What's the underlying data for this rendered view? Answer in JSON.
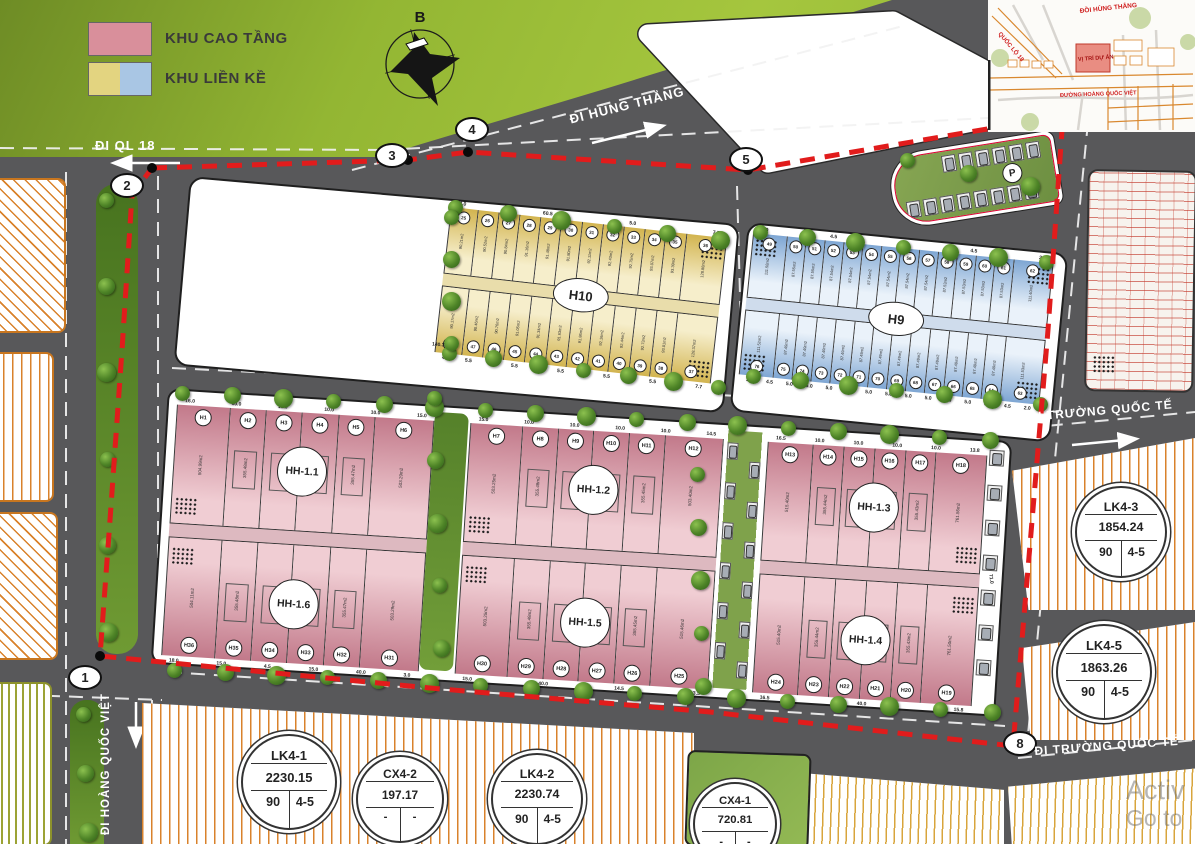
{
  "legend": {
    "items": [
      {
        "label": "KHU CAO TẦNG",
        "colors": [
          "#d98f9b"
        ]
      },
      {
        "label": "KHU LIỀN KỀ",
        "colors": [
          "#e3d480",
          "#a9c6e4"
        ]
      }
    ]
  },
  "compass": {
    "label": "B"
  },
  "road_labels": {
    "ql18": "ĐI QL 18",
    "hung_thang": "ĐI HÙNG THẮNG",
    "truong_quoc_te_upper": "ĐI TRƯỜNG QUỐC TẾ",
    "truong_quoc_te_lower": "ĐI TRƯỜNG QUỐC TẾ",
    "hoang_quoc_viet": "ĐI HOÀNG QUỐC VIỆT"
  },
  "boundary_nodes": [
    {
      "label": "1"
    },
    {
      "label": "2"
    },
    {
      "label": "3"
    },
    {
      "label": "4"
    },
    {
      "label": "5"
    },
    {
      "label": "8"
    }
  ],
  "parking": {
    "label": "P"
  },
  "blocks": {
    "h10": {
      "label": "H10",
      "dims_top": [
        "4.0",
        "60.5",
        "5.0",
        "7.7"
      ],
      "dims_bottom": [
        "4.0",
        "5.5",
        "5.5",
        "5.5",
        "5.5",
        "5.5",
        "5.0",
        "5.5",
        "5.5",
        "5.5",
        "5.5",
        "7.7"
      ],
      "top_lots": [
        {
          "no": "25",
          "area": "90.21m2"
        },
        {
          "no": "26",
          "area": "90.52m2"
        },
        {
          "no": "27",
          "area": "90.84m2"
        },
        {
          "no": "28",
          "area": "91.16m2"
        },
        {
          "no": "29",
          "area": "91.48m2"
        },
        {
          "no": "30",
          "area": "91.80m2"
        },
        {
          "no": "31",
          "area": "92.11m2"
        },
        {
          "no": "32",
          "area": "92.43m2"
        },
        {
          "no": "33",
          "area": "92.75m2"
        },
        {
          "no": "34",
          "area": "93.07m2"
        },
        {
          "no": "35",
          "area": "93.39m2"
        },
        {
          "no": "36",
          "area": "128.88m2"
        }
      ],
      "bottom_lots": [
        {
          "no": "48",
          "area": "90.17m2"
        },
        {
          "no": "47",
          "area": "90.46m2"
        },
        {
          "no": "46",
          "area": "90.76m2"
        },
        {
          "no": "45",
          "area": "91.05m2"
        },
        {
          "no": "44",
          "area": "91.34m2"
        },
        {
          "no": "43",
          "area": "91.63m2"
        },
        {
          "no": "42",
          "area": "91.86m2"
        },
        {
          "no": "41",
          "area": "92.16m2"
        },
        {
          "no": "40",
          "area": "92.44m2"
        },
        {
          "no": "39",
          "area": "92.73m2"
        },
        {
          "no": "38",
          "area": "93.01m2"
        },
        {
          "no": "37",
          "area": "128.37m2"
        }
      ]
    },
    "h9": {
      "label": "H9",
      "dims_top": [
        "2.0",
        "4.5",
        "60.0",
        "4.5",
        "2.0"
      ],
      "dims_bottom": [
        "2.0",
        "4.5",
        "5.0",
        "5.0",
        "5.0",
        "5.0",
        "5.0",
        "5.0",
        "5.0",
        "5.0",
        "5.0",
        "5.0",
        "5.0",
        "4.5",
        "2.0"
      ],
      "top_lots": [
        {
          "no": "49",
          "area": "111.58m2"
        },
        {
          "no": "50",
          "area": "87.55m2"
        },
        {
          "no": "51",
          "area": "87.55m2"
        },
        {
          "no": "52",
          "area": "87.54m2"
        },
        {
          "no": "53",
          "area": "87.54m2"
        },
        {
          "no": "54",
          "area": "87.54m2"
        },
        {
          "no": "55",
          "area": "87.54m2"
        },
        {
          "no": "56",
          "area": "87.54m2"
        },
        {
          "no": "57",
          "area": "87.54m2"
        },
        {
          "no": "58",
          "area": "87.53m2"
        },
        {
          "no": "59",
          "area": "87.53m2"
        },
        {
          "no": "60",
          "area": "87.53m2"
        },
        {
          "no": "61",
          "area": "87.53m2"
        },
        {
          "no": "62",
          "area": "111.40m2"
        }
      ],
      "bottom_lots": [
        {
          "no": "76",
          "area": "111.52m2"
        },
        {
          "no": "75",
          "area": "87.49m2"
        },
        {
          "no": "74",
          "area": "87.49m2"
        },
        {
          "no": "73",
          "area": "87.49m2"
        },
        {
          "no": "72",
          "area": "87.49m2"
        },
        {
          "no": "71",
          "area": "87.49m2"
        },
        {
          "no": "70",
          "area": "87.49m2"
        },
        {
          "no": "69",
          "area": "87.49m2"
        },
        {
          "no": "68",
          "area": "87.49m2"
        },
        {
          "no": "67",
          "area": "87.49m2"
        },
        {
          "no": "66",
          "area": "87.49m2"
        },
        {
          "no": "65",
          "area": "87.49m2"
        },
        {
          "no": "64",
          "area": "87.49m2"
        },
        {
          "no": "63",
          "area": "111.53m2"
        }
      ]
    },
    "hh": [
      {
        "label": "HH-1.1",
        "dims": [
          "16.0",
          "10.0",
          "10.0",
          "10.0",
          "10.0",
          "15.0"
        ],
        "lots": [
          {
            "no": "H1",
            "area": "504.99m2"
          },
          {
            "no": "H2",
            "area": "355.48m2"
          },
          {
            "no": "H3",
            "area": "355.48m2"
          },
          {
            "no": "H4",
            "area": "355.47m2"
          },
          {
            "no": "H5",
            "area": "355.47m2"
          },
          {
            "no": "H6",
            "area": "503.29m2"
          }
        ]
      },
      {
        "label": "HH-1.6",
        "dims": [
          "18.0",
          "15.0",
          "4.5",
          "15.0",
          "40.0",
          "3.0"
        ],
        "lots": [
          {
            "no": "H36",
            "area": "504.11m2"
          },
          {
            "no": "H35",
            "area": "355.48m2"
          },
          {
            "no": "H34",
            "area": "355.48m2"
          },
          {
            "no": "H33",
            "area": "355.47m2"
          },
          {
            "no": "H32",
            "area": "355.47m2"
          },
          {
            "no": "H31",
            "area": "503.29m2"
          }
        ]
      },
      {
        "label": "HH-1.2",
        "dims": [
          "15.0",
          "10.0",
          "10.0",
          "10.0",
          "10.0",
          "14.5"
        ],
        "lots": [
          {
            "no": "H7",
            "area": "503.25m2"
          },
          {
            "no": "H8",
            "area": "355.48m2"
          },
          {
            "no": "H9",
            "area": "355.48m2"
          },
          {
            "no": "H10",
            "area": "355.45m2"
          },
          {
            "no": "H11",
            "area": "355.45m2"
          },
          {
            "no": "H12",
            "area": "503.40m2"
          }
        ]
      },
      {
        "label": "HH-1.5",
        "dims": [
          "15.0",
          "40.0",
          "14.5",
          "13.5"
        ],
        "lots": [
          {
            "no": "H30",
            "area": "503.25m2"
          },
          {
            "no": "H29",
            "area": "355.48m2"
          },
          {
            "no": "H28",
            "area": "355.48m2"
          },
          {
            "no": "H27",
            "area": "355.45m2"
          },
          {
            "no": "H26",
            "area": "355.45m2"
          },
          {
            "no": "H25",
            "area": "515.46m2"
          }
        ]
      },
      {
        "label": "HH-1.3",
        "dims": [
          "16.5",
          "10.0",
          "10.0",
          "10.0",
          "10.0",
          "13.8"
        ],
        "lots": [
          {
            "no": "H13",
            "area": "515.40m2"
          },
          {
            "no": "H14",
            "area": "355.44m2"
          },
          {
            "no": "H15",
            "area": "355.44m2"
          },
          {
            "no": "H16",
            "area": "355.43m2"
          },
          {
            "no": "H17",
            "area": "355.43m2"
          },
          {
            "no": "H18",
            "area": "761.56m2"
          }
        ]
      },
      {
        "label": "HH-1.4",
        "dims": [
          "16.5",
          "40.0",
          "15.8"
        ],
        "lots": [
          {
            "no": "H24",
            "area": "515.40m2"
          },
          {
            "no": "H23",
            "area": "355.44m2"
          },
          {
            "no": "H22",
            "area": "355.44m2"
          },
          {
            "no": "H21",
            "area": "355.43m2"
          },
          {
            "no": "H20",
            "area": "355.43m2"
          },
          {
            "no": "H19",
            "area": "761.50m2"
          }
        ]
      }
    ],
    "info_circles": [
      {
        "name": "LK4-1",
        "area": "2230.15",
        "c1": "90",
        "c2": "4-5"
      },
      {
        "name": "CX4-2",
        "area": "197.17",
        "c1": "-",
        "c2": "-"
      },
      {
        "name": "LK4-2",
        "area": "2230.74",
        "c1": "90",
        "c2": "4-5"
      },
      {
        "name": "CX4-1",
        "area": "720.81",
        "c1": "-",
        "c2": "-"
      },
      {
        "name": "LK4-3",
        "area": "1854.24",
        "c1": "90",
        "c2": "4-5"
      },
      {
        "name": "LK4-5",
        "area": "1863.26",
        "c1": "90",
        "c2": "4-5"
      }
    ]
  },
  "misc_dims": [
    "140.3",
    "71.0"
  ],
  "inset": {
    "labels": {
      "top": "ĐỒI HÙNG THẮNG",
      "left": "QUỐC LỘ 18",
      "site": "VỊ TRÍ DỰ ÁN",
      "road": "ĐƯỜNG HOÀNG QUỐC VIỆT"
    }
  },
  "watermark": {
    "line1": "Activ",
    "line2": "Go to"
  }
}
